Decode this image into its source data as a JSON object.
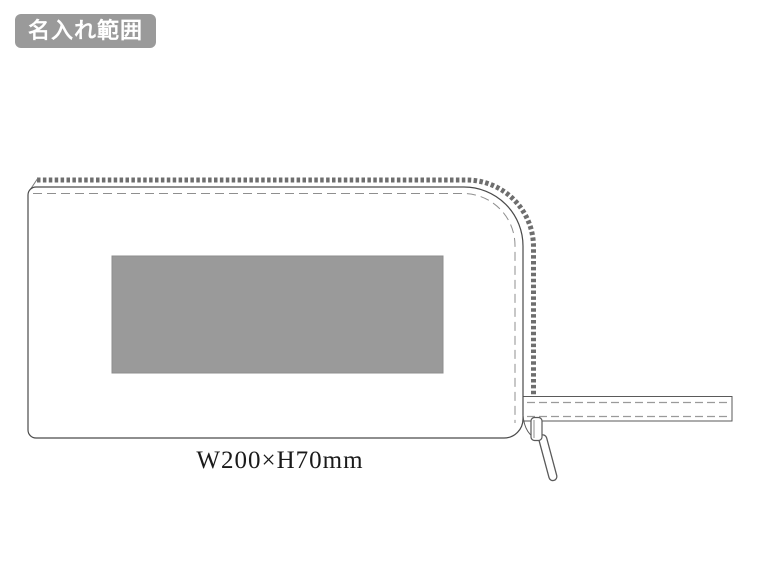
{
  "badge": {
    "label": "名入れ範囲"
  },
  "dimension_label": {
    "text": "W200×H70mm"
  },
  "illustration": {
    "subject": "zipper-pouch-line-drawing",
    "parts": [
      "pouch-body-outline",
      "zipper-teeth",
      "stitch-line",
      "print-area-rect",
      "zipper-tape-extension",
      "zipper-slider",
      "zipper-pull"
    ]
  },
  "colors": {
    "background": "#ffffff",
    "badge_bg": "#9a9a9a",
    "badge_text": "#ffffff",
    "print_area_fill": "#9a9a9a",
    "print_area_border": "#8d8d8d",
    "outline": "#4a4a4a",
    "stitch": "#8f8f8f",
    "zipper_teeth": "#6e6e6e",
    "tape_edge": "#5a5a5a"
  }
}
